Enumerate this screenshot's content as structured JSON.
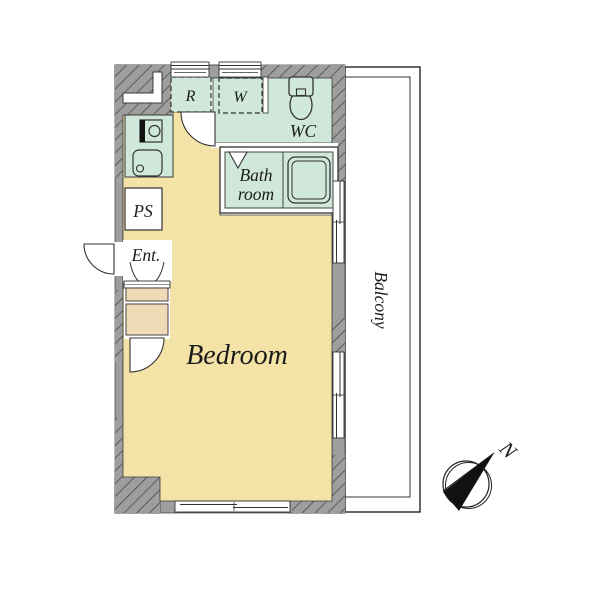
{
  "floor_plan": {
    "labels": {
      "bedroom": "Bedroom",
      "balcony": "Balcony",
      "bath_line1": "Bath",
      "bath_line2": "room",
      "wc": "WC",
      "refrigerator_space": "R",
      "washer_space": "W",
      "pipe_shaft": "PS",
      "entrance": "Ent.",
      "compass_north": "N"
    },
    "colors": {
      "wall_gray": "#9e9e9e",
      "bedroom_tan": "#f4e3a7",
      "wet_area_mint": "#cfe8d9",
      "closet_tan": "#f1dab6",
      "outline": "#3a3a3a",
      "background": "#ffffff"
    }
  }
}
